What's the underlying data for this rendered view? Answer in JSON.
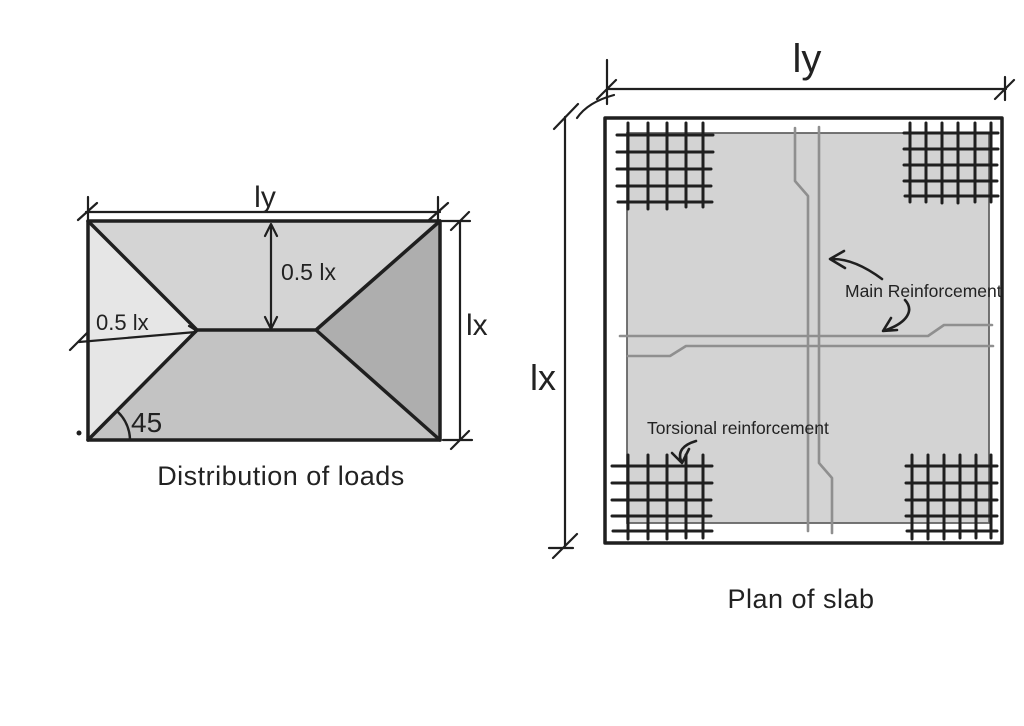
{
  "page": {
    "background": "#ffffff"
  },
  "colors": {
    "ink": "#1f1f1f",
    "rebar_gray": "#8f8f8f",
    "left_triangle_fill": "#e6e6e6",
    "top_trapezoid_fill": "#d4d4d4",
    "bottom_trapezoid_fill": "#c3c3c3",
    "right_triangle_fill": "#aeaeae",
    "slab_margin_fill": "#e9e9e9",
    "slab_core_fill": "#d3d3d3"
  },
  "load_distribution_figure": {
    "caption": "Distribution of loads",
    "labels": {
      "span_long": "ly",
      "span_short": "lx",
      "half_span_vertical": "0.5 lx",
      "half_span_horizontal": "0.5 lx",
      "angle_degrees": "45"
    }
  },
  "slab_plan_figure": {
    "caption": "Plan of slab",
    "labels": {
      "span_long": "ly",
      "span_short": "lx",
      "main_reinforcement": "Main Reinforcement",
      "torsional_reinforcement": "Torsional reinforcement"
    }
  }
}
